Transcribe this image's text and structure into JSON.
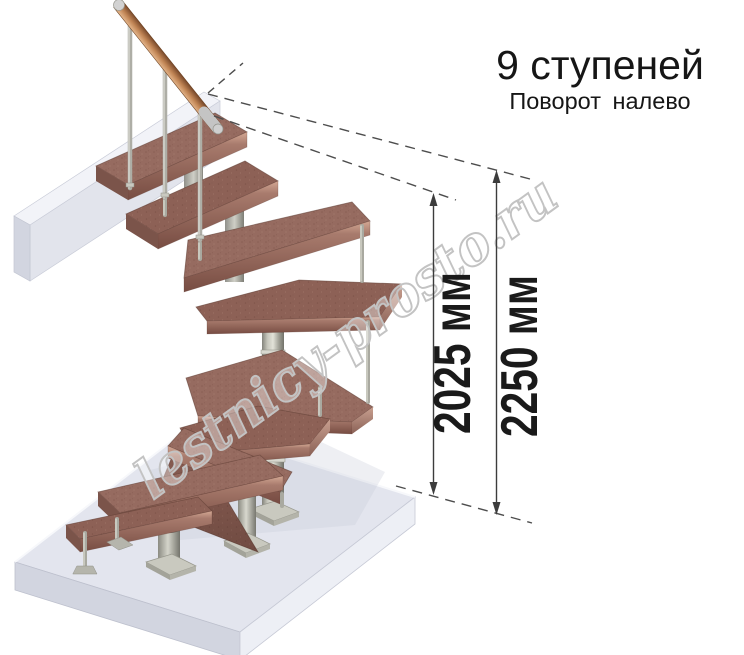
{
  "header": {
    "title": "9 ступеней",
    "subtitle": "Поворот  налево"
  },
  "dimensions": [
    {
      "label": "2025 мм",
      "value_mm": 2025
    },
    {
      "label": "2250 мм",
      "value_mm": 2250
    }
  ],
  "watermark": {
    "text": "lestnicy-prosto.ru",
    "color": "#c3c3c3"
  },
  "illustration": {
    "type": "3d-render-modular-spiral-staircase",
    "steps_total": 9,
    "turn_direction": "налево",
    "colors": {
      "tread_wood": "#966b60",
      "tread_edge": "#7a4f45",
      "metal_column": "#b5b5ac",
      "handrail_wood": "#b57a50",
      "floor_slab": "#e3e5ee",
      "dimension_lines": "#3c3c3c",
      "text": "#161616"
    }
  }
}
